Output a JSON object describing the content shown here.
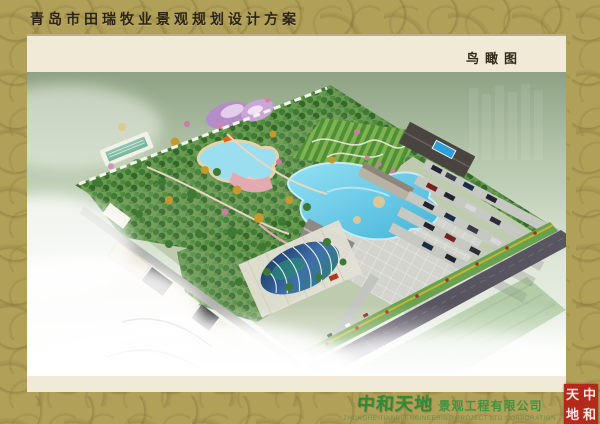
{
  "header": {
    "title": "青岛市田瑞牧业景观规划设计方案"
  },
  "view_label": "鸟瞰图",
  "footer": {
    "logo_cn": "中和天地",
    "company": "景观工程有限公司",
    "company_en": "ZHONGHE TIANDI ENGINEERING PROJECT LTD CORPORATION",
    "seal": {
      "chars": [
        "天",
        "中",
        "地",
        "和"
      ]
    }
  },
  "colors": {
    "frame_gold": "#b1a058",
    "frame_pattern": "#7a6630",
    "panel_cream": "#f0ead7",
    "title_text": "#2b2315",
    "logo_green": "#2f8b35",
    "seal_red": "#b5291b",
    "lake_blue": "#5ecbe8",
    "pool_teal": "#1f8a6a",
    "dome_glass": "#2a4f86",
    "garden_purple": "#b48cc8",
    "road_dark": "#585460",
    "foliage_green": "#3e7a33",
    "foliage_autumn": "#c49a2e"
  },
  "scene": {
    "type": "aerial-rendering",
    "features": [
      "site-boundary",
      "forest-belt",
      "central-lake",
      "water-park-pool",
      "lap-swimming-pool",
      "butterfly-flower-garden",
      "hedge-maze-field",
      "paved-plaza",
      "glass-dome-conservatory",
      "service-buildings",
      "truck-parking-rows",
      "flower-strips",
      "perimeter-road",
      "entrance-road",
      "mist-overlay"
    ]
  }
}
